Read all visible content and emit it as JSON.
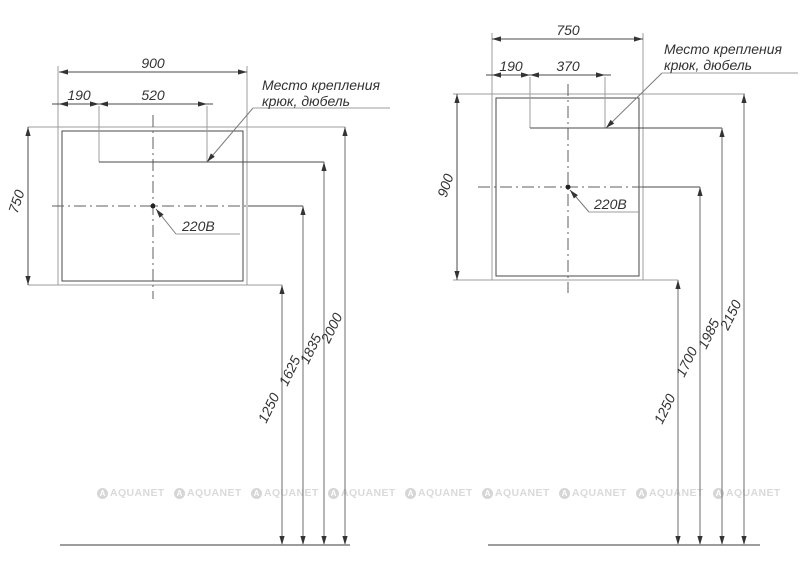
{
  "left": {
    "width": "900",
    "hook_offset": "190",
    "hook_spacing": "520",
    "height": "750",
    "note_line1": "Место крепления",
    "note_line2": "крюк, дюбель",
    "power": "220В",
    "heights": [
      "1250",
      "1625",
      "1835",
      "2000"
    ]
  },
  "right": {
    "width": "750",
    "hook_offset": "190",
    "hook_spacing": "370",
    "height": "900",
    "note_line1": "Место крепления",
    "note_line2": "крюк, дюбель",
    "power": "220В",
    "heights": [
      "1250",
      "1700",
      "1985",
      "2150"
    ]
  },
  "watermark": {
    "logo_letter": "A",
    "text": "AQUANET"
  }
}
